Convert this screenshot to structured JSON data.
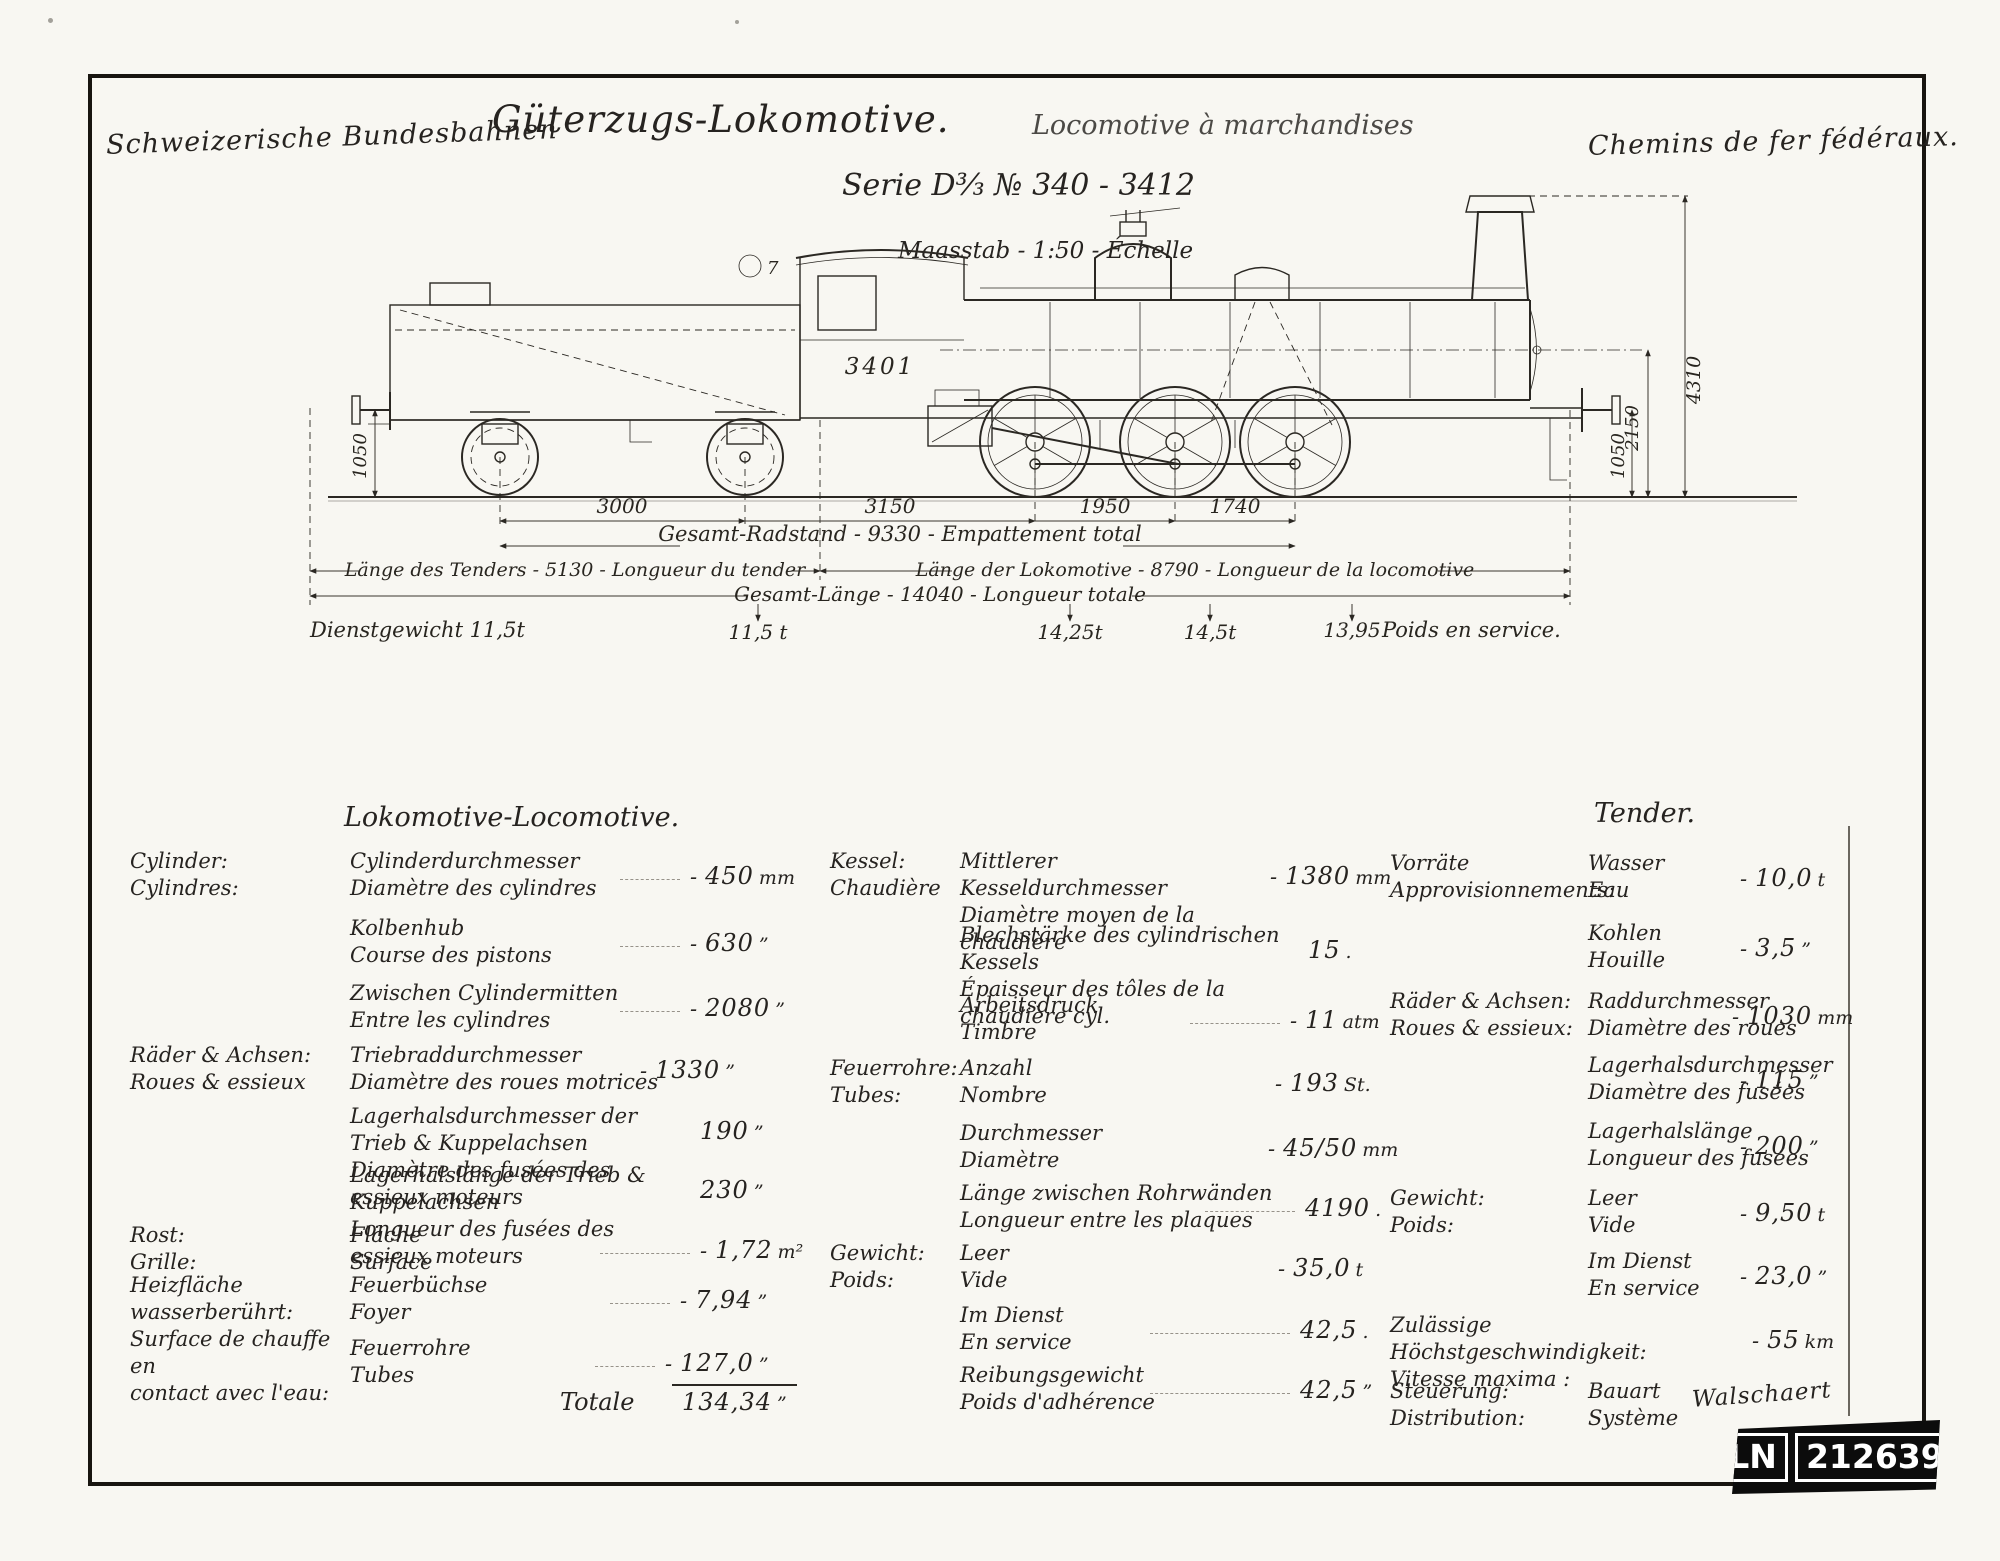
{
  "header": {
    "org_de": "Schweizerische Bundesbahnen",
    "org_fr": "Chemins de fer fédéraux.",
    "title_de": "Güterzugs-Lokomotive.",
    "title_fr": "Locomotive à marchandises",
    "series": "Serie D³⁄₃  № 340 - 3412",
    "scale": "Maasstab - 1:50 - Échelle"
  },
  "drawing": {
    "loco_number": "3401",
    "figure_mark": "7",
    "axle_dims": [
      "3000",
      "3150",
      "1950",
      "1740"
    ],
    "wheelbase": "Gesamt-Radstand - 9330 - Empattement total",
    "tender_length": "Länge des Tenders - 5130 - Longueur du tender",
    "loco_length": "Länge der Lokomotive - 8790 - Longueur de la locomotive",
    "total_length": "Gesamt-Länge - 14040 - Longueur totale",
    "service_weight_label": "Dienstgewicht 11,5t",
    "axle_weights": [
      "11,5 t",
      "14,25t",
      "14,5t",
      "13,95"
    ],
    "service_weight_fr": "Poids en service.",
    "height_chimney": "4310",
    "height_boiler": "2150",
    "buffer_left": "1050",
    "buffer_right": "1050"
  },
  "table": {
    "loco_heading": "Lokomotive-Locomotive.",
    "tender_heading": "Tender.",
    "totale_label": "Totale",
    "totale_value": "134,34",
    "totale_unit": "”",
    "loco_rows": [
      {
        "c1": "Cylinder:",
        "c2": "Cylindres:",
        "i1": "Cylinderdurchmesser",
        "i2": "Diamètre des cylindres",
        "d": "-",
        "v": "450",
        "u": "mm"
      },
      {
        "i1": "Kolbenhub",
        "i2": "Course des pistons",
        "d": "-",
        "v": "630",
        "u": "”"
      },
      {
        "i1": "Zwischen Cylindermitten",
        "i2": "Entre les cylindres",
        "d": "-",
        "v": "2080",
        "u": "”"
      },
      {
        "c1": "Räder & Achsen:",
        "c2": "Roues & essieux",
        "i1": "Triebraddurchmesser",
        "i2": "Diamètre des roues motrices",
        "d": "-",
        "v": "1330",
        "u": "”"
      },
      {
        "i1": "Lagerhalsdurchmesser der Trieb & Kuppelachsen",
        "i2": "Diamètre des fusées des essieux moteurs",
        "v": "190",
        "u": "”"
      },
      {
        "i1": "Lagerhalslänge der Trieb & Kuppelachsen",
        "i2": "Longueur des fusées des essieux moteurs",
        "v": "230",
        "u": "”"
      },
      {
        "c1": "Rost:",
        "c2": "Grille:",
        "i1": "Fläche",
        "i2": "Surface",
        "d": "-",
        "v": "1,72",
        "u": "m²"
      },
      {
        "c1": "Heizfläche wasserberührt:",
        "c2": "Surface de chauffe en",
        "c3": "contact avec l'eau:",
        "i1": "Feuerbüchse",
        "i2": "Foyer",
        "d": "-",
        "v": "7,94",
        "u": "”"
      },
      {
        "i1": "Feuerrohre",
        "i2": "Tubes",
        "d": "-",
        "v": "127,0",
        "u": "”"
      }
    ],
    "boiler_rows": [
      {
        "c1": "Kessel:",
        "c2": "Chaudière",
        "i1": "Mittlerer Kesseldurchmesser",
        "i2": "Diamètre moyen de la chaudière",
        "d": "-",
        "v": "1380",
        "u": "mm"
      },
      {
        "i1": "Blechstärke des cylindrischen Kessels",
        "i2": "Épaisseur des tôles de la chaudière cyl.",
        "v": "15",
        "u": "."
      },
      {
        "i1": "Arbeitsdruck",
        "i2": "Timbre",
        "d": "-",
        "v": "11",
        "u": "atm"
      },
      {
        "c1": "Feuerrohre:",
        "c2": "Tubes:",
        "i1": "Anzahl",
        "i2": "Nombre",
        "d": "-",
        "v": "193",
        "u": "St."
      },
      {
        "i1": "Durchmesser",
        "i2": "Diamètre",
        "d": "-",
        "v": "45/50",
        "u": "mm"
      },
      {
        "i1": "Länge zwischen Rohrwänden",
        "i2": "Longueur entre les plaques",
        "v": "4190",
        "u": "."
      },
      {
        "c1": "Gewicht:",
        "c2": "Poids:",
        "i1": "Leer",
        "i2": "Vide",
        "d": "-",
        "v": "35,0",
        "u": "t"
      },
      {
        "i1": "Im Dienst",
        "i2": "En service",
        "v": "42,5",
        "u": "."
      },
      {
        "i1": "Reibungsgewicht",
        "i2": "Poids d'adhérence",
        "v": "42,5",
        "u": "”"
      }
    ],
    "tender_rows": [
      {
        "c1": "Vorräte",
        "c2": "Approvisionnements:",
        "i1": "Wasser",
        "i2": "Eau",
        "d": "-",
        "v": "10,0",
        "u": "t"
      },
      {
        "i1": "Kohlen",
        "i2": "Houille",
        "d": "-",
        "v": "3,5",
        "u": "”"
      },
      {
        "c1": "Räder & Achsen:",
        "c2": "Roues & essieux:",
        "i1": "Raddurchmesser",
        "i2": "Diamètre des roues",
        "d": "-",
        "v": "1030",
        "u": "mm"
      },
      {
        "i1": "Lagerhalsdurchmesser",
        "i2": "Diamètre des fusées",
        "d": "-",
        "v": "115",
        "u": "”"
      },
      {
        "i1": "Lagerhalslänge",
        "i2": "Longueur des fusées",
        "d": "-",
        "v": "200",
        "u": "”"
      },
      {
        "c1": "Gewicht:",
        "c2": "Poids:",
        "i1": "Leer",
        "i2": "Vide",
        "d": "-",
        "v": "9,50",
        "u": "t"
      },
      {
        "i1": "Im Dienst",
        "i2": "En service",
        "d": "-",
        "v": "23,0",
        "u": "”"
      },
      {
        "c1": "Zulässige Höchstgeschwindigkeit:",
        "c2": "Vitesse maxima :",
        "d": "-",
        "v": "55",
        "u": "km"
      },
      {
        "c1": "Steuerung:",
        "c2": "Distribution:",
        "i1": "Bauart",
        "i2": "Système",
        "v": "Walschaert"
      }
    ]
  },
  "stamp": {
    "code": "LN",
    "number": "212639"
  }
}
